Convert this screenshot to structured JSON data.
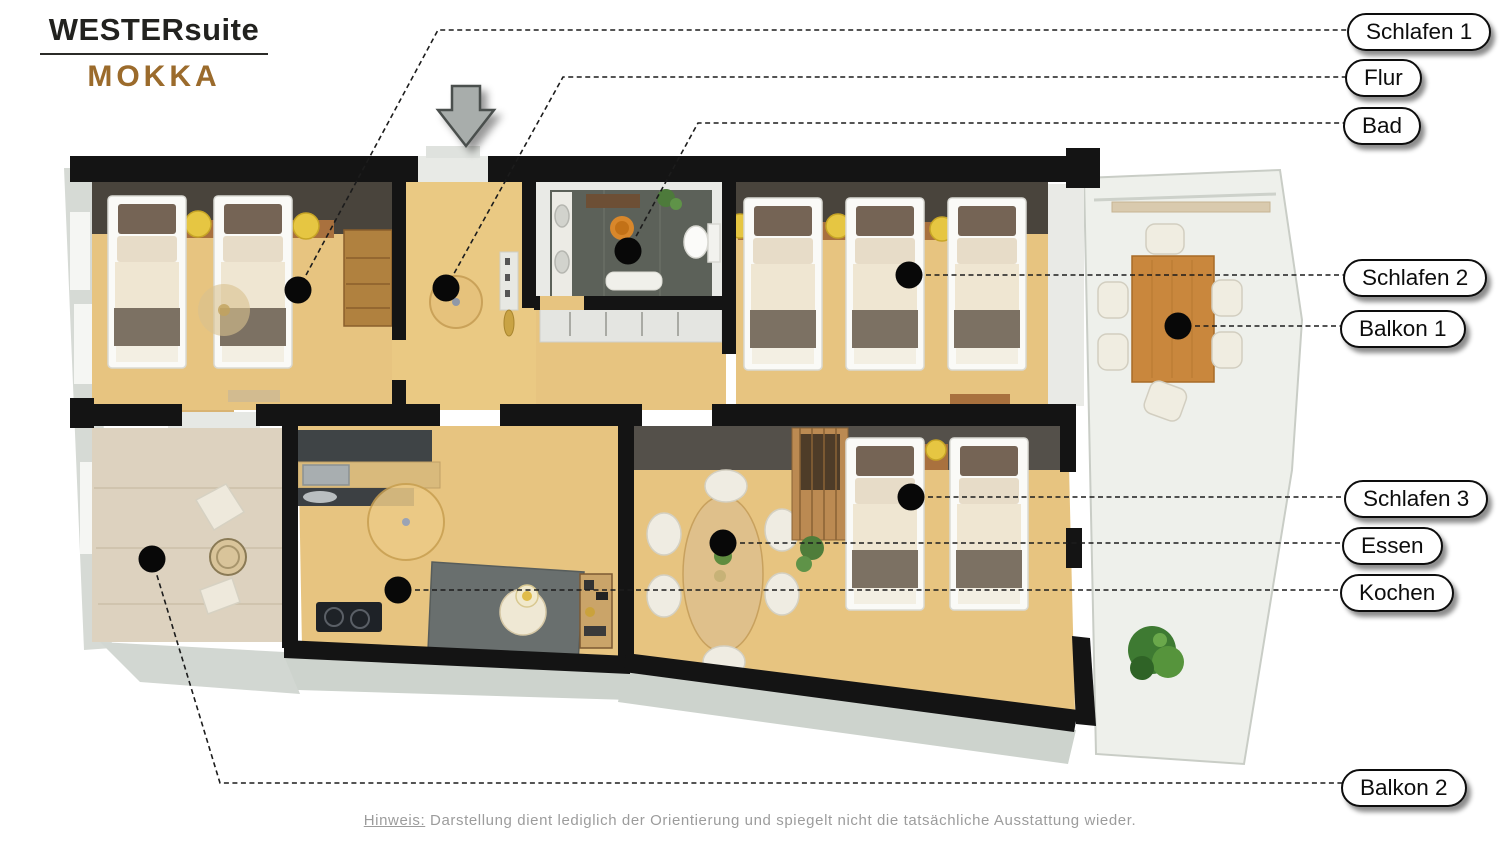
{
  "branding": {
    "brand": "WESTERsuite",
    "suite": "MOKKA"
  },
  "labels": [
    {
      "id": "schlafen-1",
      "text": "Schlafen 1"
    },
    {
      "id": "flur",
      "text": "Flur"
    },
    {
      "id": "bad",
      "text": "Bad"
    },
    {
      "id": "schlafen-2",
      "text": "Schlafen 2"
    },
    {
      "id": "balkon-1",
      "text": "Balkon 1"
    },
    {
      "id": "schlafen-3",
      "text": "Schlafen 3"
    },
    {
      "id": "essen",
      "text": "Essen"
    },
    {
      "id": "kochen",
      "text": "Kochen"
    },
    {
      "id": "balkon-2",
      "text": "Balkon 2"
    }
  ],
  "footnote": {
    "prefix": "Hinweis:",
    "text": "Darstellung dient lediglich der Orientierung und spiegelt nicht die tatsächliche Ausstattung wieder."
  },
  "colors": {
    "brand_brown": "#9b6b2c",
    "wall_black": "#141414",
    "wood_floor": "#e6c37e",
    "dark_wall_strip": "#49443c",
    "bath_tile": "#5c6159",
    "balcony_deck": "#eef0eb",
    "stone_floor": "#ddd2bf",
    "lamp_yellow": "#e6c642"
  }
}
